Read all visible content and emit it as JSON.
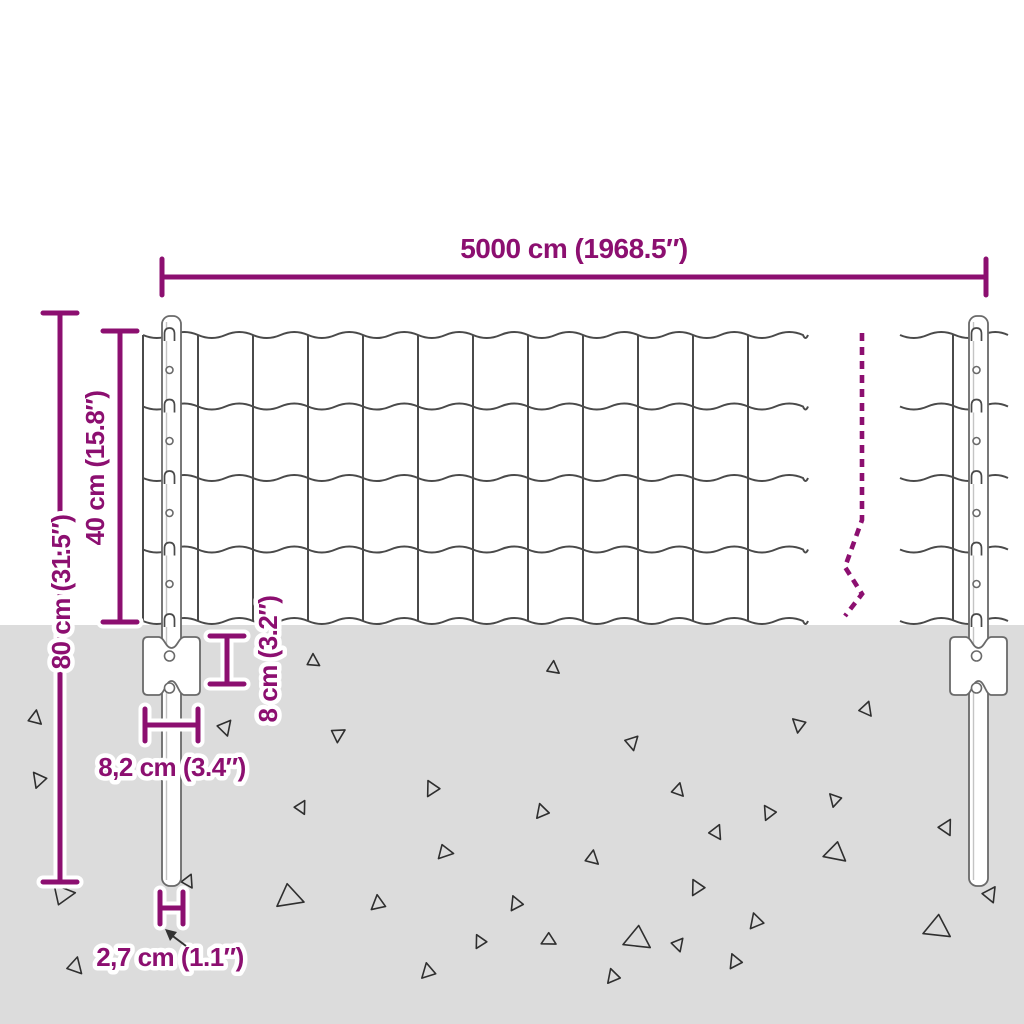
{
  "title": "Fence panel with posts — dimension diagram",
  "dimension_labels": {
    "total_width": "5000 cm (1968.5″)",
    "total_height": "80 cm (31.5″)",
    "mesh_height": "40 cm (15.8″)",
    "anchor_plate_height": "8 cm (3.2″)",
    "anchor_plate_width": "8,2 cm (3.4″)",
    "post_width": "2,7 cm (1.1″)"
  },
  "colors": {
    "dimension_accent": "#8C0F70",
    "ground": "#DCDCDC",
    "wire": "#4A4A4A",
    "post_outline": "#6A6A6A"
  },
  "ground": {
    "rocks": [
      [
        35,
        718,
        13,
        10
      ],
      [
        39,
        780,
        14,
        200
      ],
      [
        62,
        894,
        20,
        320
      ],
      [
        75,
        966,
        15,
        15
      ],
      [
        225,
        727,
        14,
        40
      ],
      [
        188,
        881,
        12,
        25
      ],
      [
        290,
        897,
        24,
        110
      ],
      [
        313,
        661,
        12,
        0
      ],
      [
        553,
        668,
        12,
        5
      ],
      [
        338,
        734,
        13,
        60
      ],
      [
        632,
        742,
        13,
        45
      ],
      [
        432,
        789,
        14,
        210
      ],
      [
        301,
        807,
        12,
        30
      ],
      [
        542,
        812,
        13,
        220
      ],
      [
        445,
        852,
        14,
        100
      ],
      [
        592,
        858,
        13,
        10
      ],
      [
        378,
        904,
        14,
        230
      ],
      [
        516,
        904,
        13,
        215
      ],
      [
        480,
        942,
        12,
        210
      ],
      [
        549,
        940,
        13,
        120
      ],
      [
        638,
        939,
        24,
        125
      ],
      [
        613,
        977,
        13,
        220
      ],
      [
        428,
        972,
        14,
        225
      ],
      [
        678,
        944,
        12,
        40
      ],
      [
        735,
        962,
        13,
        215
      ],
      [
        866,
        709,
        13,
        20
      ],
      [
        799,
        725,
        13,
        190
      ],
      [
        678,
        790,
        12,
        15
      ],
      [
        835,
        800,
        12,
        195
      ],
      [
        769,
        813,
        13,
        205
      ],
      [
        716,
        832,
        13,
        25
      ],
      [
        836,
        853,
        20,
        130
      ],
      [
        946,
        827,
        14,
        30
      ],
      [
        697,
        888,
        14,
        210
      ],
      [
        756,
        922,
        14,
        220
      ],
      [
        938,
        928,
        24,
        125
      ],
      [
        990,
        894,
        14,
        35
      ]
    ]
  }
}
